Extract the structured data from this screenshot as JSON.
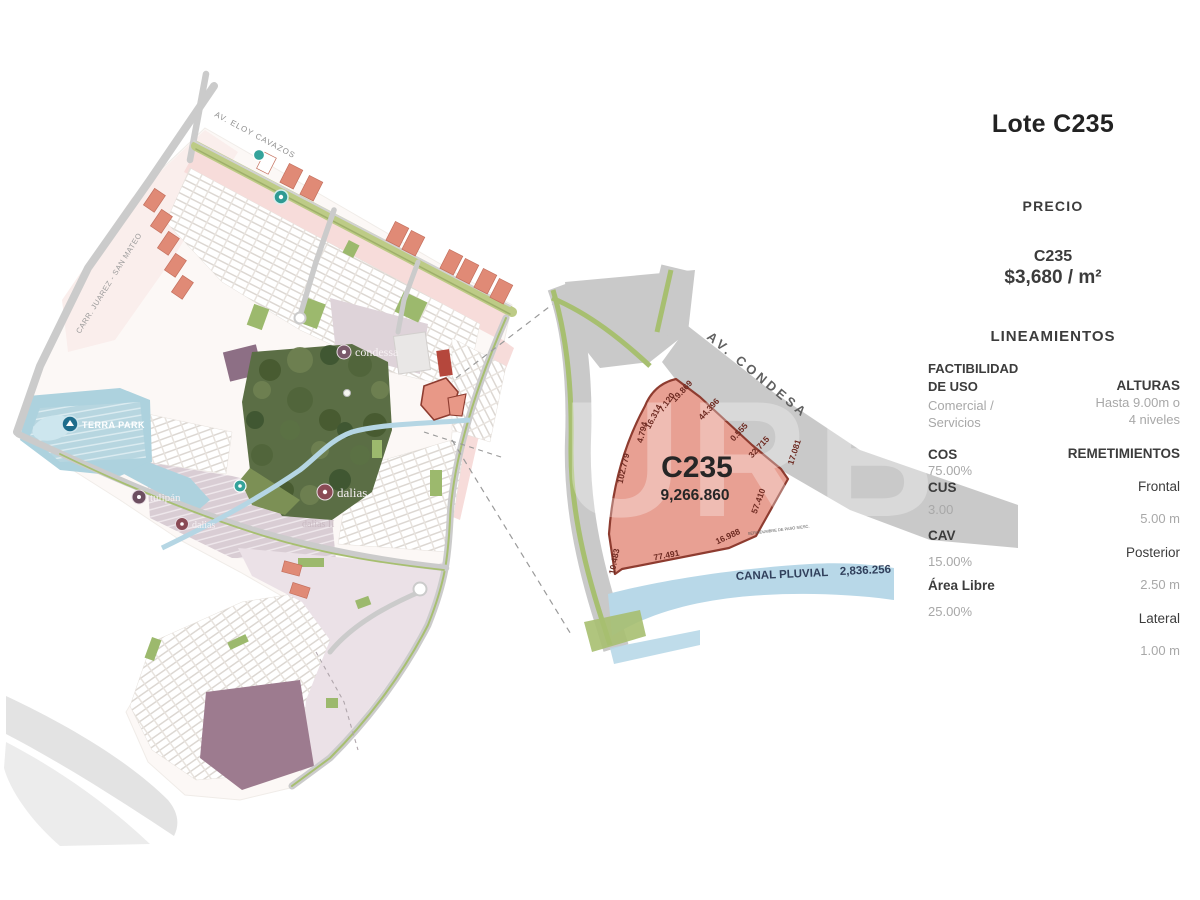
{
  "watermark": "URB",
  "master_plan": {
    "roads": {
      "eloy": "AV. ELOY CAVAZOS",
      "juarez": "CARR. JUAREZ - SAN MATEO"
    },
    "labels": {
      "terra_park": "TERRA PARK",
      "condessa": "condessa",
      "tulipan": "tulipán",
      "dalias_left": "dalias",
      "dalias": "dalias",
      "dalias2": "dalias II"
    }
  },
  "detail": {
    "road": "AV. CONDESA",
    "lot_id": "C235",
    "lot_area": "9,266.860",
    "canal_label": "CANAL PLUVIAL",
    "canal_value": "2,836.256",
    "easement": "SERVIDUMBRE DE PASO S/ESC.",
    "dims": [
      "4.794",
      "16.314",
      "7.120",
      "19.869",
      "44.396",
      "0.555",
      "32.715",
      "17.081",
      "102.779",
      "57.410",
      "16.988",
      "77.491",
      "10.483"
    ]
  },
  "panel": {
    "title": "Lote C235",
    "precio": "PRECIO",
    "price_lot": "C235",
    "price_value": "$3,680 / m²",
    "lineamientos": "LINEAMIENTOS",
    "factibilidad1": "FACTIBILIDAD",
    "factibilidad2": "DE USO",
    "uso1": "Comercial /",
    "uso2": "Servicios",
    "cos": "COS",
    "cos_v": "75.00%",
    "cus": "CUS",
    "cus_v": "3.00",
    "cav": "CAV",
    "cav_v": "15.00%",
    "area_libre": "Área Libre",
    "area_libre_v": "25.00%",
    "alturas": "ALTURAS",
    "alturas1": "Hasta 9.00m o",
    "alturas2": "4 niveles",
    "remetimientos": "REMETIMIENTOS",
    "frontal": "Frontal",
    "frontal_v": "5.00 m",
    "posterior": "Posterior",
    "posterior_v": "2.50 m",
    "lateral": "Lateral",
    "lateral_v": "1.00 m"
  },
  "colors": {
    "lot_fill": "#e8a093",
    "lot_border": "#8e3c30",
    "road_gray": "#c9c9c9",
    "median_green": "#a7bf70",
    "canal_blue": "#b8d8e8",
    "commercial_red": "#e08a76",
    "park_dark_green": "#5b6e45",
    "terra_park_blue": "#add2de",
    "purple_lot": "#9d7b8f"
  }
}
